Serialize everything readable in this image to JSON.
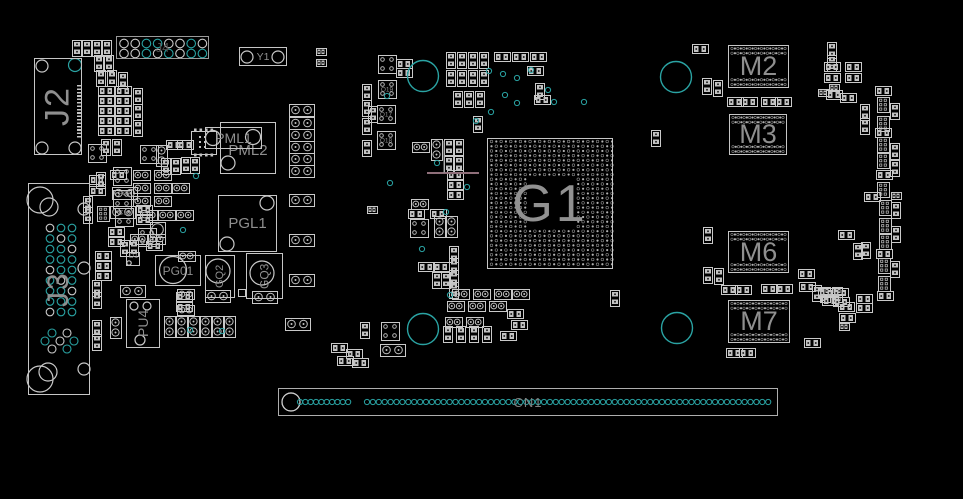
{
  "colors": {
    "bg": "#000000",
    "silk": "#c9c9c9",
    "pad": "#c2c2c2",
    "teal": "#2aa3a3",
    "label": "#8f8f8f",
    "trace": "#8f6f7a"
  },
  "refs": {
    "j2": "J2",
    "j3": "J3",
    "j4": "J4",
    "y1": "Y1",
    "pml1": "PML1",
    "pml2": "PML2",
    "pgl1": "PGL1",
    "pg01": "PG01",
    "gq2": "GQ2",
    "gq3": "GQ3",
    "pu4": "PU4",
    "d1": "D1",
    "g1": "G1",
    "m2": "M2",
    "m3": "M3",
    "m6": "M6",
    "m7": "M7",
    "cn1": "CN1"
  },
  "holes": [
    [
      423,
      76
    ],
    [
      676,
      77
    ],
    [
      423,
      329
    ],
    [
      677,
      328
    ]
  ],
  "vias": [
    [
      489,
      71
    ],
    [
      503,
      74
    ],
    [
      517,
      78
    ],
    [
      531,
      70
    ],
    [
      505,
      95
    ],
    [
      517,
      103
    ],
    [
      491,
      112
    ],
    [
      476,
      121
    ],
    [
      548,
      90
    ],
    [
      554,
      102
    ],
    [
      584,
      102
    ],
    [
      387,
      96
    ],
    [
      390,
      183
    ],
    [
      437,
      163
    ],
    [
      467,
      187
    ],
    [
      446,
      212
    ],
    [
      422,
      249
    ],
    [
      450,
      295
    ],
    [
      196,
      176
    ],
    [
      183,
      230
    ],
    [
      190,
      330
    ],
    [
      222,
      331
    ]
  ],
  "rings": [
    [
      42,
      66,
      6,
      0
    ],
    [
      75,
      65,
      6.5,
      1
    ],
    [
      42,
      148,
      6,
      0
    ],
    [
      75,
      148,
      6,
      0
    ],
    [
      247,
      57,
      6,
      0
    ],
    [
      278,
      57,
      6,
      0
    ],
    [
      213,
      138,
      7.5,
      0
    ],
    [
      253,
      137,
      7.5,
      0
    ],
    [
      228,
      163,
      7,
      0
    ],
    [
      267,
      203,
      7,
      0
    ],
    [
      227,
      244,
      7,
      0
    ],
    [
      173,
      270,
      13.5,
      0
    ],
    [
      218,
      271,
      12,
      0
    ],
    [
      262,
      273,
      12,
      0
    ],
    [
      134,
      306,
      4,
      0
    ],
    [
      147,
      306,
      4,
      0
    ],
    [
      140,
      340,
      5,
      0
    ],
    [
      129,
      263,
      2.2,
      0
    ],
    [
      291,
      402,
      9,
      0
    ]
  ],
  "trace": {
    "h": [
      427,
      173,
      479,
      173
    ],
    "v": [
      444,
      141,
      444,
      173
    ]
  },
  "j4": {
    "cx0": 124,
    "step": 11.2,
    "rowy": [
      43.5,
      53.5
    ],
    "r": 4.3,
    "teal": [
      [
        0,
        0,
        1,
        1,
        0,
        0,
        1,
        0
      ],
      [
        0,
        0,
        1,
        0,
        1,
        0,
        1,
        1
      ]
    ]
  },
  "j3grid": {
    "cols": [
      50,
      61,
      72
    ],
    "row0": 228,
    "step": 10.5,
    "rows": 9,
    "r": 3.8,
    "stagger": [
      [
        52,
        333
      ],
      [
        67,
        333
      ],
      [
        45,
        341
      ],
      [
        60,
        341
      ],
      [
        74,
        341
      ],
      [
        52,
        349
      ],
      [
        67,
        349
      ]
    ],
    "side": [
      [
        84,
        209,
        6
      ],
      [
        84,
        268,
        6
      ],
      [
        84,
        369,
        6
      ]
    ],
    "corner": [
      [
        40,
        200,
        13
      ],
      [
        49,
        207,
        9
      ],
      [
        40,
        379,
        13
      ],
      [
        48,
        372,
        9
      ]
    ]
  },
  "g1grid": {
    "x": 491.5,
    "y": 141.5,
    "cols": 26,
    "rows": 27,
    "sx": 4.82,
    "sy": 4.72,
    "band": 8,
    "bandb": 19
  },
  "mem": [
    {
      "x": 728,
      "y": 45,
      "w": 61,
      "h": 43
    },
    {
      "x": 729,
      "y": 114,
      "w": 58,
      "h": 41
    },
    {
      "x": 728,
      "y": 231,
      "w": 61,
      "h": 42
    },
    {
      "x": 728,
      "y": 300,
      "w": 62,
      "h": 43
    }
  ],
  "cn1": {
    "big": [
      291,
      402,
      9
    ],
    "cy": 402,
    "r": 2.6,
    "groups": [
      [
        300,
        10,
        5.35
      ],
      [
        367,
        69,
        5.9
      ]
    ]
  },
  "parts": [
    [
      "r2v",
      72,
      40
    ],
    [
      "r2v",
      82,
      40
    ],
    [
      "r2v",
      92,
      40
    ],
    [
      "r2v",
      102,
      40
    ],
    [
      "r2v",
      94,
      55
    ],
    [
      "r2v",
      104,
      55
    ],
    [
      "r2v",
      96,
      70
    ],
    [
      "r2v",
      107,
      70
    ],
    [
      "r2v",
      118,
      72
    ],
    [
      "r2h",
      98,
      86
    ],
    [
      "r2h",
      115,
      86
    ],
    [
      "r2h",
      98,
      96
    ],
    [
      "r2h",
      115,
      96
    ],
    [
      "r2h",
      98,
      106
    ],
    [
      "r2h",
      115,
      106
    ],
    [
      "r2h",
      98,
      116
    ],
    [
      "r2h",
      115,
      116
    ],
    [
      "r2h",
      98,
      126
    ],
    [
      "r2h",
      115,
      126
    ],
    [
      "r2v",
      133,
      88
    ],
    [
      "r2v",
      133,
      104
    ],
    [
      "r2v",
      133,
      120
    ],
    [
      "q4",
      88,
      144
    ],
    [
      "r2v",
      101,
      139
    ],
    [
      "r2v",
      112,
      139
    ],
    [
      "q4",
      113,
      167
    ],
    [
      "c2h",
      112,
      187,
      "PC8"
    ],
    [
      "c2h",
      110,
      206,
      "PC13"
    ],
    [
      "r2h",
      89,
      175
    ],
    [
      "r2h",
      89,
      186
    ],
    [
      "r2v",
      83,
      196
    ],
    [
      "r2v",
      83,
      207
    ],
    [
      "q4",
      140,
      145
    ],
    [
      "c2v",
      156,
      145
    ],
    [
      "r2h",
      166,
      140
    ],
    [
      "r2h",
      177,
      140
    ],
    [
      "ic8",
      191,
      131
    ],
    [
      "r2v",
      161,
      158
    ],
    [
      "r2v",
      171,
      158
    ],
    [
      "r2v",
      181,
      157
    ],
    [
      "r2v",
      190,
      157
    ],
    [
      "c2hs",
      133,
      170
    ],
    [
      "c2hs",
      154,
      170
    ],
    [
      "c2hs",
      133,
      183
    ],
    [
      "c2hs",
      154,
      183
    ],
    [
      "c2hs",
      172,
      183
    ],
    [
      "c2hs",
      133,
      196
    ],
    [
      "c2hs",
      154,
      196
    ],
    [
      "c2hs",
      140,
      210
    ],
    [
      "c2hs",
      158,
      210
    ],
    [
      "c2hs",
      176,
      210
    ],
    [
      "circ",
      150,
      222
    ],
    [
      "c2hs",
      130,
      234
    ],
    [
      "c2hs",
      148,
      234
    ],
    [
      "r2v",
      96,
      172
    ],
    [
      "r2h",
      110,
      170
    ],
    [
      "q4",
      113,
      190
    ],
    [
      "p6v",
      97,
      206
    ],
    [
      "q4",
      115,
      208
    ],
    [
      "r2h",
      136,
      205
    ],
    [
      "r2h",
      136,
      215
    ],
    [
      "r2h",
      108,
      227
    ],
    [
      "r2h",
      108,
      237
    ],
    [
      "q4",
      138,
      228
    ],
    [
      "r2v",
      120,
      240
    ],
    [
      "r2v",
      129,
      240
    ],
    [
      "r2h",
      95,
      251
    ],
    [
      "r2h",
      95,
      261
    ],
    [
      "r2h",
      95,
      271
    ],
    [
      "c2h",
      120,
      285
    ],
    [
      "r2v",
      92,
      280
    ],
    [
      "r2v",
      92,
      292
    ],
    [
      "c2v",
      110,
      317
    ],
    [
      "r2v",
      92,
      320
    ],
    [
      "r2v",
      92,
      334
    ],
    [
      "r2h",
      146,
      241
    ],
    [
      "c2hs",
      178,
      251
    ],
    [
      "c2hs",
      177,
      289
    ],
    [
      "c2hs",
      177,
      305
    ],
    [
      "c2h",
      289,
      104
    ],
    [
      "c2h",
      289,
      117
    ],
    [
      "c2h",
      289,
      129
    ],
    [
      "c2h",
      289,
      141
    ],
    [
      "c2h",
      289,
      153
    ],
    [
      "c2h",
      289,
      165
    ],
    [
      "c2h",
      289,
      194
    ],
    [
      "c2h",
      289,
      234
    ],
    [
      "c2h",
      289,
      274
    ],
    [
      "c2h",
      285,
      318
    ],
    [
      "r2s",
      316,
      48
    ],
    [
      "r2s",
      316,
      59
    ],
    [
      "c2v",
      164,
      316
    ],
    [
      "c2v",
      176,
      316
    ],
    [
      "c2v",
      188,
      316
    ],
    [
      "c2v",
      200,
      316
    ],
    [
      "c2v",
      212,
      316
    ],
    [
      "c2v",
      224,
      316
    ],
    [
      "r2h",
      176,
      292
    ],
    [
      "r2h",
      176,
      302
    ],
    [
      "c2h",
      205,
      290
    ],
    [
      "sq",
      238,
      289
    ],
    [
      "c2h",
      252,
      291
    ],
    [
      "r2v",
      360,
      322
    ],
    [
      "r2h",
      331,
      343
    ],
    [
      "r2h",
      346,
      349
    ],
    [
      "r2h",
      337,
      356
    ],
    [
      "r2h",
      352,
      358
    ],
    [
      "q4",
      378,
      55
    ],
    [
      "q4",
      378,
      80,
      "Q19"
    ],
    [
      "q4",
      377,
      105,
      "Q17"
    ],
    [
      "q4",
      377,
      131,
      "Q18"
    ],
    [
      "r2v",
      362,
      84
    ],
    [
      "r2v",
      362,
      100
    ],
    [
      "r2v",
      362,
      118
    ],
    [
      "r2v",
      362,
      140
    ],
    [
      "r2h",
      396,
      59
    ],
    [
      "r2h",
      396,
      68
    ],
    [
      "r2v",
      446,
      52
    ],
    [
      "r2v",
      457,
      52
    ],
    [
      "r2v",
      468,
      52
    ],
    [
      "r2v",
      479,
      52
    ],
    [
      "r2v",
      446,
      70
    ],
    [
      "r2v",
      457,
      70
    ],
    [
      "r2v",
      468,
      70
    ],
    [
      "r2v",
      479,
      70
    ],
    [
      "r2v",
      453,
      91
    ],
    [
      "r2v",
      464,
      91
    ],
    [
      "r2v",
      475,
      91
    ],
    [
      "r2h",
      494,
      52
    ],
    [
      "r2h",
      512,
      52
    ],
    [
      "r2h",
      530,
      52
    ],
    [
      "r2h",
      527,
      66
    ],
    [
      "r2v",
      535,
      83
    ],
    [
      "r2h",
      534,
      95
    ],
    [
      "r2v",
      473,
      116
    ],
    [
      "c2hs",
      412,
      142
    ],
    [
      "c2v",
      431,
      139
    ],
    [
      "r2v",
      444,
      139
    ],
    [
      "r2v",
      454,
      139
    ],
    [
      "r2v",
      444,
      156
    ],
    [
      "r2v",
      454,
      156
    ],
    [
      "r2h",
      447,
      170
    ],
    [
      "r2h",
      447,
      180
    ],
    [
      "r2h",
      447,
      190
    ],
    [
      "r2v",
      368,
      106
    ],
    [
      "r2s",
      367,
      206
    ],
    [
      "c2hs",
      411,
      199
    ],
    [
      "r2h",
      408,
      209
    ],
    [
      "r2h",
      430,
      209
    ],
    [
      "q4",
      410,
      219
    ],
    [
      "c2v",
      434,
      216
    ],
    [
      "c2v",
      446,
      216
    ],
    [
      "r2v",
      449,
      246
    ],
    [
      "r2v",
      449,
      258
    ],
    [
      "r2v",
      449,
      270
    ],
    [
      "r2v",
      449,
      282
    ],
    [
      "r2h",
      418,
      262
    ],
    [
      "r2h",
      433,
      262
    ],
    [
      "r2v",
      432,
      272
    ],
    [
      "r2v",
      441,
      272
    ],
    [
      "c2hs",
      452,
      289
    ],
    [
      "c2hs",
      473,
      289
    ],
    [
      "c2hs",
      494,
      289
    ],
    [
      "c2hs",
      512,
      289
    ],
    [
      "c2hs",
      447,
      301
    ],
    [
      "c2hs",
      468,
      301
    ],
    [
      "c2hs",
      489,
      301
    ],
    [
      "r2h",
      507,
      309
    ],
    [
      "c2hs",
      445,
      317
    ],
    [
      "c2hs",
      466,
      317
    ],
    [
      "r2h",
      511,
      320
    ],
    [
      "r2v",
      443,
      326
    ],
    [
      "r2v",
      456,
      326
    ],
    [
      "r2v",
      469,
      326
    ],
    [
      "r2v",
      482,
      326
    ],
    [
      "r2h",
      500,
      331
    ],
    [
      "q4",
      381,
      322
    ],
    [
      "c2h",
      380,
      344
    ],
    [
      "r2v",
      610,
      290
    ],
    [
      "r2h",
      692,
      44
    ],
    [
      "r2v",
      702,
      78
    ],
    [
      "r2v",
      713,
      80
    ],
    [
      "r2v",
      651,
      130
    ],
    [
      "r2v",
      703,
      227
    ],
    [
      "r2v",
      703,
      267
    ],
    [
      "r2v",
      714,
      268
    ],
    [
      "r2h",
      727,
      97
    ],
    [
      "r2h",
      741,
      97
    ],
    [
      "r2h",
      761,
      97
    ],
    [
      "r2h",
      775,
      97
    ],
    [
      "r2h",
      721,
      285
    ],
    [
      "r2h",
      735,
      285
    ],
    [
      "r2h",
      761,
      284
    ],
    [
      "r2h",
      776,
      284
    ],
    [
      "r2h",
      726,
      348
    ],
    [
      "r2h",
      739,
      348
    ],
    [
      "r2h",
      804,
      338
    ],
    [
      "r2v",
      827,
      42
    ],
    [
      "r2v",
      827,
      55
    ],
    [
      "r2h",
      824,
      62
    ],
    [
      "r2h",
      845,
      62
    ],
    [
      "r2h",
      824,
      73
    ],
    [
      "r2h",
      845,
      73
    ],
    [
      "r2s",
      829,
      84
    ],
    [
      "r2h",
      826,
      90
    ],
    [
      "r2h",
      840,
      93
    ],
    [
      "r2s",
      818,
      89
    ],
    [
      "r2h",
      875,
      86
    ],
    [
      "p6v",
      877,
      97
    ],
    [
      "r2v",
      890,
      103
    ],
    [
      "r2v",
      860,
      104
    ],
    [
      "r2v",
      860,
      118
    ],
    [
      "p6v",
      877,
      116
    ],
    [
      "r2h",
      875,
      128
    ],
    [
      "p6v",
      877,
      137
    ],
    [
      "r2v",
      890,
      143
    ],
    [
      "p6v",
      877,
      153
    ],
    [
      "r2v",
      890,
      160
    ],
    [
      "r2h",
      876,
      170
    ],
    [
      "p6v",
      877,
      182
    ],
    [
      "r2s",
      891,
      192
    ],
    [
      "r2h",
      864,
      192
    ],
    [
      "p6v",
      879,
      200
    ],
    [
      "r2v",
      891,
      202
    ],
    [
      "p6v",
      879,
      218
    ],
    [
      "r2v",
      891,
      226
    ],
    [
      "r2h",
      838,
      230
    ],
    [
      "p6v",
      879,
      234
    ],
    [
      "r2v",
      853,
      243
    ],
    [
      "r2v",
      861,
      242
    ],
    [
      "r2h",
      876,
      249
    ],
    [
      "p6v",
      878,
      258
    ],
    [
      "r2v",
      890,
      261
    ],
    [
      "p6v",
      878,
      276
    ],
    [
      "r2h",
      877,
      291
    ],
    [
      "r2s",
      820,
      287
    ],
    [
      "r2s",
      832,
      287
    ],
    [
      "r2s",
      820,
      295
    ],
    [
      "r2s",
      832,
      295
    ],
    [
      "r2h",
      856,
      294
    ],
    [
      "r2h",
      856,
      303
    ],
    [
      "r2h",
      838,
      302
    ],
    [
      "r2h",
      839,
      313
    ],
    [
      "r2s",
      839,
      323
    ],
    [
      "r2h",
      798,
      269
    ],
    [
      "r2h",
      799,
      282
    ],
    [
      "r2v",
      812,
      285
    ],
    [
      "r2h",
      818,
      288
    ],
    [
      "r2h",
      832,
      288
    ],
    [
      "r2h",
      822,
      296
    ],
    [
      "r2h",
      833,
      297
    ]
  ]
}
